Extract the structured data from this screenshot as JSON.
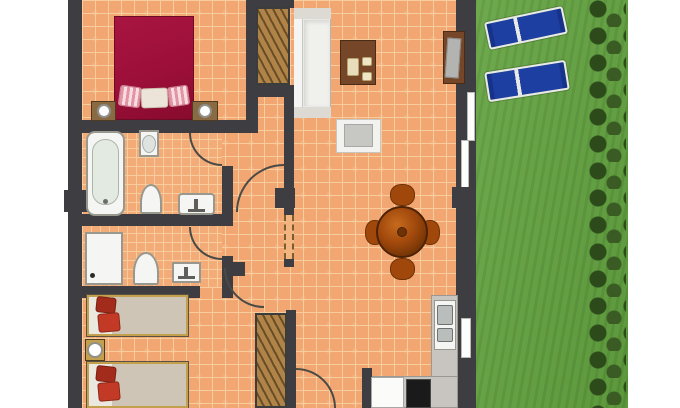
{
  "meta": {
    "title": "Holiday apartment floor plan: two bedrooms, two bathrooms, living-dining room with kitchen corner, and private lawn garden with two sun loungers"
  },
  "colors": {
    "wall": "#3e3e42",
    "tile": "#f2a772",
    "grout": "#f8cd9e",
    "grass": "#63a340",
    "hedge": "#2c4a1a",
    "lounger": "#1e3fa2",
    "lounger_frame": "#e9e9e7",
    "bed_master": "#9c0f39",
    "wood_dark": "#764628",
    "wood_dining": "#a0480c",
    "wardrobe": "#b08449",
    "counter": "#c8c5c0",
    "fixture_white": "#f5f5f3",
    "fixture_border": "#98988f",
    "mattress": "#cfc5b6",
    "sheet": "#ebe8e0",
    "pillow_red": "#c23a26",
    "pillow_red_dark": "#a32b1c",
    "bed_frame": "#c2a04e",
    "window_white": "#fdfdfb",
    "door_arc": "#4a4a46",
    "nightstand": "#8a6a42",
    "tv_gray": "#b3b3b1",
    "stove_black": "#1a1a1a"
  },
  "rooms": [
    {
      "id": "bedroom-master",
      "position": "top-left",
      "furniture": [
        "double-bed",
        "pillow-striped-left",
        "pillow-white-center",
        "pillow-striped-right",
        "nightstand-with-lamp-left",
        "nightstand-with-lamp-right"
      ]
    },
    {
      "id": "bathroom-1",
      "position": "mid-left",
      "furniture": [
        "bathtub",
        "washbasin",
        "toilet",
        "bidet"
      ],
      "doors": [
        "arched-door-top-right"
      ]
    },
    {
      "id": "bathroom-2",
      "position": "mid-left-lower",
      "furniture": [
        "shower-tray",
        "toilet",
        "washbasin"
      ],
      "doors": [
        "arched-door-top-right"
      ]
    },
    {
      "id": "bedroom-2",
      "position": "bottom-left",
      "furniture": [
        "single-bed-upper",
        "single-bed-lower",
        "nightstand-with-lamp",
        "wardrobe"
      ],
      "doors": [
        "arched-door-top-right"
      ]
    },
    {
      "id": "living-dining",
      "position": "center",
      "furniture": [
        "wardrobe",
        "sofa",
        "coffee-table-with-cups",
        "tv-sideboard",
        "white-side-table",
        "round-dining-table",
        "dining-chairs-x4"
      ],
      "openings": [
        "sliding-door-to-garden",
        "arched-hall-door",
        "dashed-opening",
        "door-bottom"
      ]
    },
    {
      "id": "kitchen-corner",
      "position": "bottom-right",
      "furniture": [
        "sink-two-basins",
        "worktop-right",
        "worktop-bottom",
        "dishwasher",
        "oven"
      ],
      "openings": [
        "window-to-garden"
      ]
    },
    {
      "id": "garden",
      "position": "right",
      "features": [
        "lawn",
        "hedge-row",
        "sun-lounger-1",
        "sun-lounger-2"
      ]
    }
  ]
}
